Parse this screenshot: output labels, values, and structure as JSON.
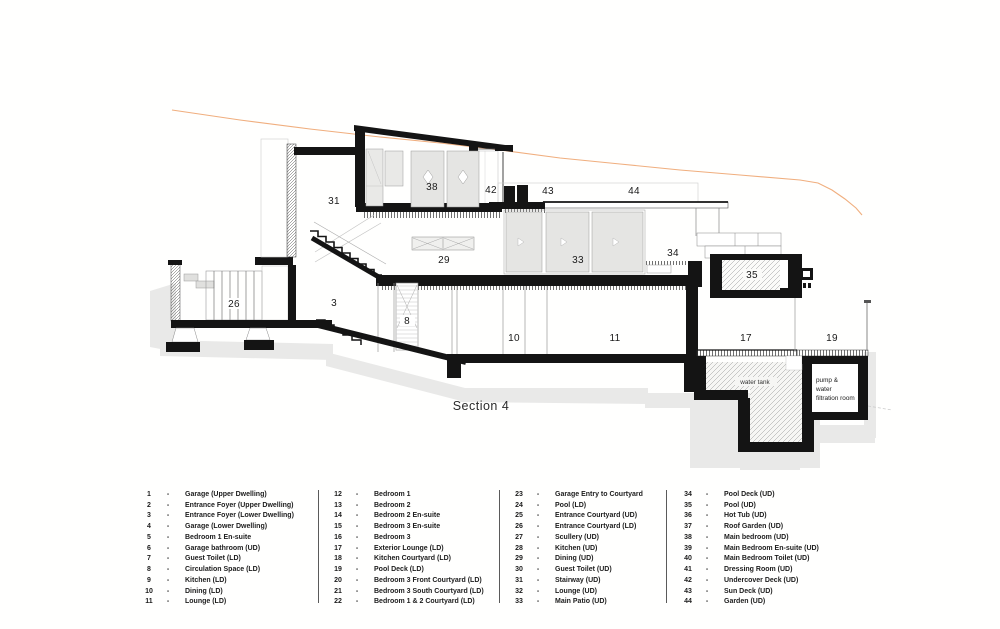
{
  "drawing": {
    "section_label": "Section 4",
    "room_labels": [
      "38",
      "42",
      "43",
      "44",
      "31",
      "29",
      "33",
      "34",
      "35",
      "26",
      "3",
      "8",
      "10",
      "11",
      "17",
      "19"
    ],
    "annotations": {
      "water_tank": "water tank",
      "pump_line1": "pump &",
      "pump_line2": "water",
      "pump_line3": "filtration room"
    },
    "colors": {
      "terrain": "#f0ae7e",
      "structure": "#141414",
      "shadow": "#e9e9e8",
      "glass": "#e5e5e3"
    }
  },
  "legend": {
    "separator": "-",
    "columns": [
      {
        "items": [
          {
            "num": "1",
            "label": "Garage (Upper Dwelling)"
          },
          {
            "num": "2",
            "label": "Entrance Foyer (Upper Dwelling)"
          },
          {
            "num": "3",
            "label": "Entrance Foyer (Lower Dwelling)"
          },
          {
            "num": "4",
            "label": "Garage (Lower Dwelling)"
          },
          {
            "num": "5",
            "label": "Bedroom 1 En-suite"
          },
          {
            "num": "6",
            "label": "Garage bathroom (UD)"
          },
          {
            "num": "7",
            "label": "Guest Toilet (LD)"
          },
          {
            "num": "8",
            "label": "Circulation Space (LD)"
          },
          {
            "num": "9",
            "label": "Kitchen (LD)"
          },
          {
            "num": "10",
            "label": "Dining (LD)"
          },
          {
            "num": "11",
            "label": "Lounge (LD)"
          }
        ]
      },
      {
        "items": [
          {
            "num": "12",
            "label": "Bedroom 1"
          },
          {
            "num": "13",
            "label": "Bedroom 2"
          },
          {
            "num": "14",
            "label": "Bedroom 2 En-suite"
          },
          {
            "num": "15",
            "label": "Bedroom 3 En-suite"
          },
          {
            "num": "16",
            "label": "Bedroom 3"
          },
          {
            "num": "17",
            "label": "Exterior Lounge (LD)"
          },
          {
            "num": "18",
            "label": "Kitchen Courtyard (LD)"
          },
          {
            "num": "19",
            "label": "Pool Deck (LD)"
          },
          {
            "num": "20",
            "label": "Bedroom 3 Front Courtyard (LD)"
          },
          {
            "num": "21",
            "label": "Bedroom 3 South Courtyard (LD)"
          },
          {
            "num": "22",
            "label": "Bedroom 1 & 2 Courtyard (LD)"
          }
        ]
      },
      {
        "items": [
          {
            "num": "23",
            "label": "Garage Entry to Courtyard"
          },
          {
            "num": "24",
            "label": "Pool (LD)"
          },
          {
            "num": "25",
            "label": "Entrance Courtyard (UD)"
          },
          {
            "num": "26",
            "label": "Entrance Courtyard (LD)"
          },
          {
            "num": "27",
            "label": "Scullery (UD)"
          },
          {
            "num": "28",
            "label": "Kitchen (UD)"
          },
          {
            "num": "29",
            "label": "Dining (UD)"
          },
          {
            "num": "30",
            "label": "Guest Toilet (UD)"
          },
          {
            "num": "31",
            "label": "Stairway (UD)"
          },
          {
            "num": "32",
            "label": "Lounge (UD)"
          },
          {
            "num": "33",
            "label": "Main Patio (UD)"
          }
        ]
      },
      {
        "items": [
          {
            "num": "34",
            "label": "Pool Deck (UD)"
          },
          {
            "num": "35",
            "label": "Pool (UD)"
          },
          {
            "num": "36",
            "label": "Hot Tub (UD)"
          },
          {
            "num": "37",
            "label": "Roof Garden (UD)"
          },
          {
            "num": "38",
            "label": "Main bedroom (UD)"
          },
          {
            "num": "39",
            "label": "Main Bedroom En-suite (UD)"
          },
          {
            "num": "40",
            "label": "Main Bedroom Toilet (UD)"
          },
          {
            "num": "41",
            "label": "Dressing Room (UD)"
          },
          {
            "num": "42",
            "label": "Undercover Deck (UD)"
          },
          {
            "num": "43",
            "label": "Sun Deck (UD)"
          },
          {
            "num": "44",
            "label": "Garden (UD)"
          }
        ]
      }
    ]
  }
}
